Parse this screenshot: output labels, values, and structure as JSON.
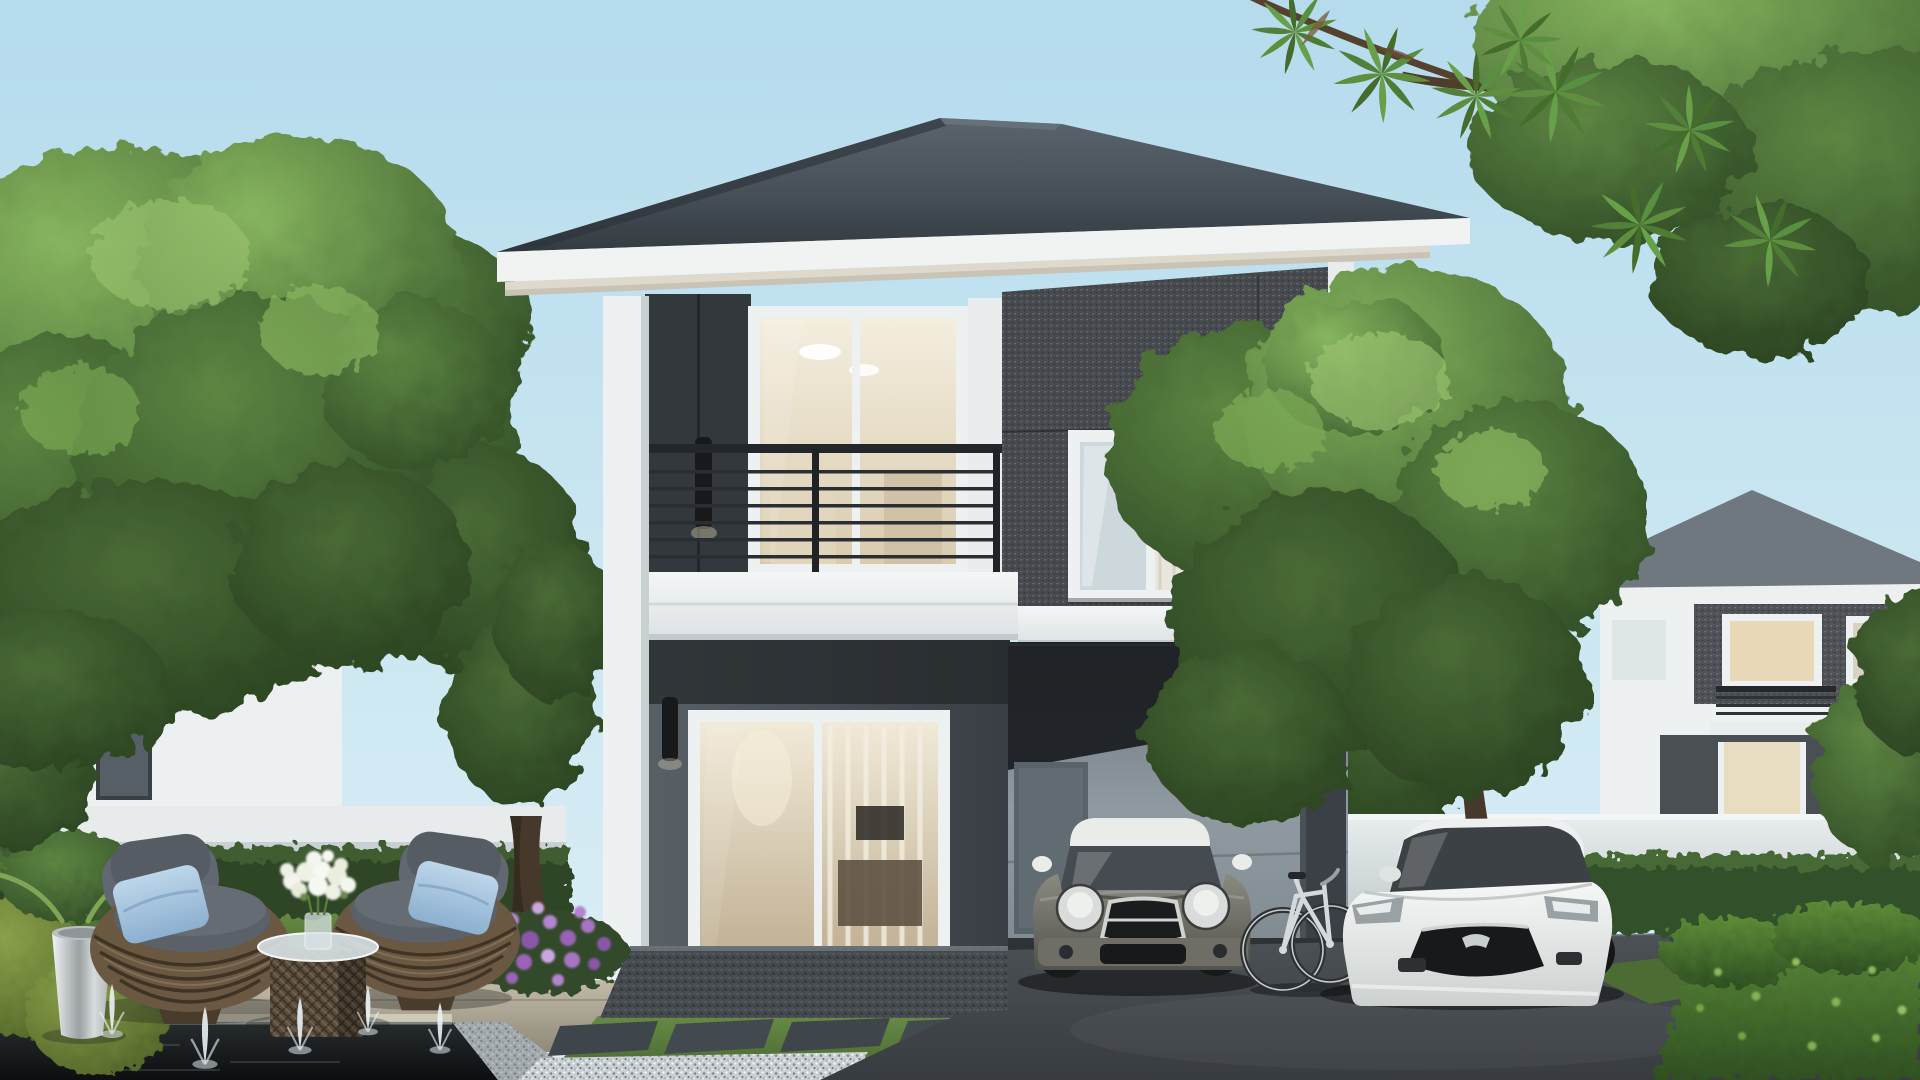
{
  "scene": {
    "title": "Modern two-storey house exterior – daytime architectural rendering",
    "type": "photorealistic-render",
    "elements": [
      "blue sky",
      "left background house",
      "right background house",
      "white boundary walls",
      "large green trees",
      "main two-storey house with grey hip roof",
      "balcony with black metal railing",
      "dark textured feature wall with window",
      "warm-lit glass sliding doors",
      "wall sconce lamps",
      "carport with interior door and dark pillar",
      "grey mini hatchback with white roof",
      "white sedan",
      "white bicycle",
      "dark asphalt driveway",
      "front lawn with dark stepping slabs",
      "white gravel paths",
      "trimmed hedges",
      "rattan lounge chairs with grey cushions and blue pillows",
      "rattan cube table with glass top and white flower bouquet",
      "stainless steel planter with green plant",
      "black reflecting pond with fountain jets",
      "purple flower bed",
      "overhanging tree branch top right"
    ]
  },
  "palette": {
    "sky_top": "#b5dbed",
    "sky_bottom": "#ddeff6",
    "roof": "#49525a",
    "roof_dark": "#343b41",
    "fascia_white": "#f1f3f3",
    "soffit": "#ded9cb",
    "wall_panel_dark": "#33383c",
    "wall_speckled": "#46494d",
    "wall_first_floor": "#4d5458",
    "carport_wall": "#8b959c",
    "carport_ceiling": "#191c1f",
    "pillar_dark": "#3a4045",
    "column_white": "#eef1f1",
    "window_frame": "#eef1f2",
    "glass_warm": "#efe8d8",
    "glass_cool": "#ccd8dc",
    "railing_black": "#23272b",
    "balcony_slab": "#f0f3f3",
    "fence_white": "#e7ebec",
    "driveway": "#43474b",
    "terrace_gravel": "#454a4f",
    "gravel_white": "#c9cfd2",
    "lawn": "#5d7f3f",
    "hedge_dark": "#2e4526",
    "hedge_bright": "#558233",
    "foliage_light": "#7fae57",
    "foliage_dark": "#2b4522",
    "trunk_brown": "#4a3c2e",
    "paving": "#b7b09e",
    "pond": "#15181b",
    "fountain_white": "#e9f2f5",
    "flower_purple": "#9a63b8",
    "flower_white": "#f3f5ef",
    "wicker": "#6a5843",
    "cushion_grey": "#5b6168",
    "pillow_blue": "#a9c6e0",
    "planter_silver": "#dfe2e3",
    "mini_body": "#75756c",
    "mini_roof": "#e9ece9",
    "mazda_white": "#eef0ef",
    "bicycle_white": "#d4dadc"
  },
  "vehicles": [
    {
      "name": "mini-hatchback",
      "body_color": "#75756c",
      "roof_color": "#e9ece9",
      "location": "under carport"
    },
    {
      "name": "white-sedan",
      "body_color": "#eef0ef",
      "location": "driveway right of carport"
    },
    {
      "name": "bicycle",
      "body_color": "#d4dadc",
      "location": "leaning on carport pillar"
    }
  ]
}
